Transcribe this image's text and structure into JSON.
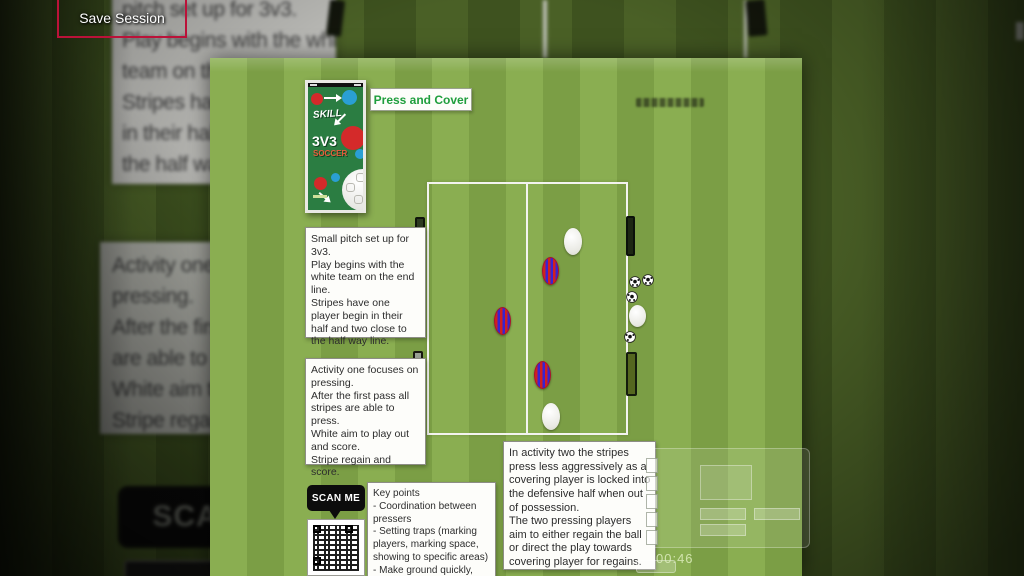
{
  "colors": {
    "accent_green": "#1f9e3d",
    "save_border": "#bb1239",
    "stripes_red": "#d12020",
    "stripes_blue": "#3a23cf"
  },
  "save_session": {
    "label": "Save Session"
  },
  "background": {
    "sheet_top_lines": [
      "pitch set up for 3v3.",
      "Play begins with the white",
      "team on the e",
      "Stripes have",
      "in their half a",
      "the half way li"
    ],
    "sheet_mid_lines": [
      "Activity one fo",
      "pressing.",
      "After the first p",
      "are able to pre",
      "White aim to p",
      "Stripe regain a"
    ],
    "scan_me": "SCAN ME"
  },
  "session": {
    "title": "Press and Cover",
    "book": {
      "title_small": "SKILL",
      "title_big": "3V3",
      "title_sub": "SOCCER"
    },
    "setup_note": "Small pitch set up for 3v3.\nPlay begins with the white team on the end line.\nStripes have one player begin in their half and two close to the half way line.",
    "activity_one_note": "Activity one focuses on pressing.\nAfter the first pass all stripes are able to press.\nWhite aim to play out and score.\nStripe regain and score.",
    "activity_two_note": "In activity two the stripes press less aggressively as a covering player is locked into the defensive half when out of possession.\nThe two pressing players aim to either regain the ball or direct the play towards covering player for regains.",
    "key_points": {
      "title": "Key points",
      "bullets": [
        "- Coordination between pressers",
        "- Setting traps (marking players, marking space, showing to specific areas)",
        "- Make ground quickly,"
      ]
    },
    "scan_me": "SCAN ME",
    "timer": "00:46"
  }
}
